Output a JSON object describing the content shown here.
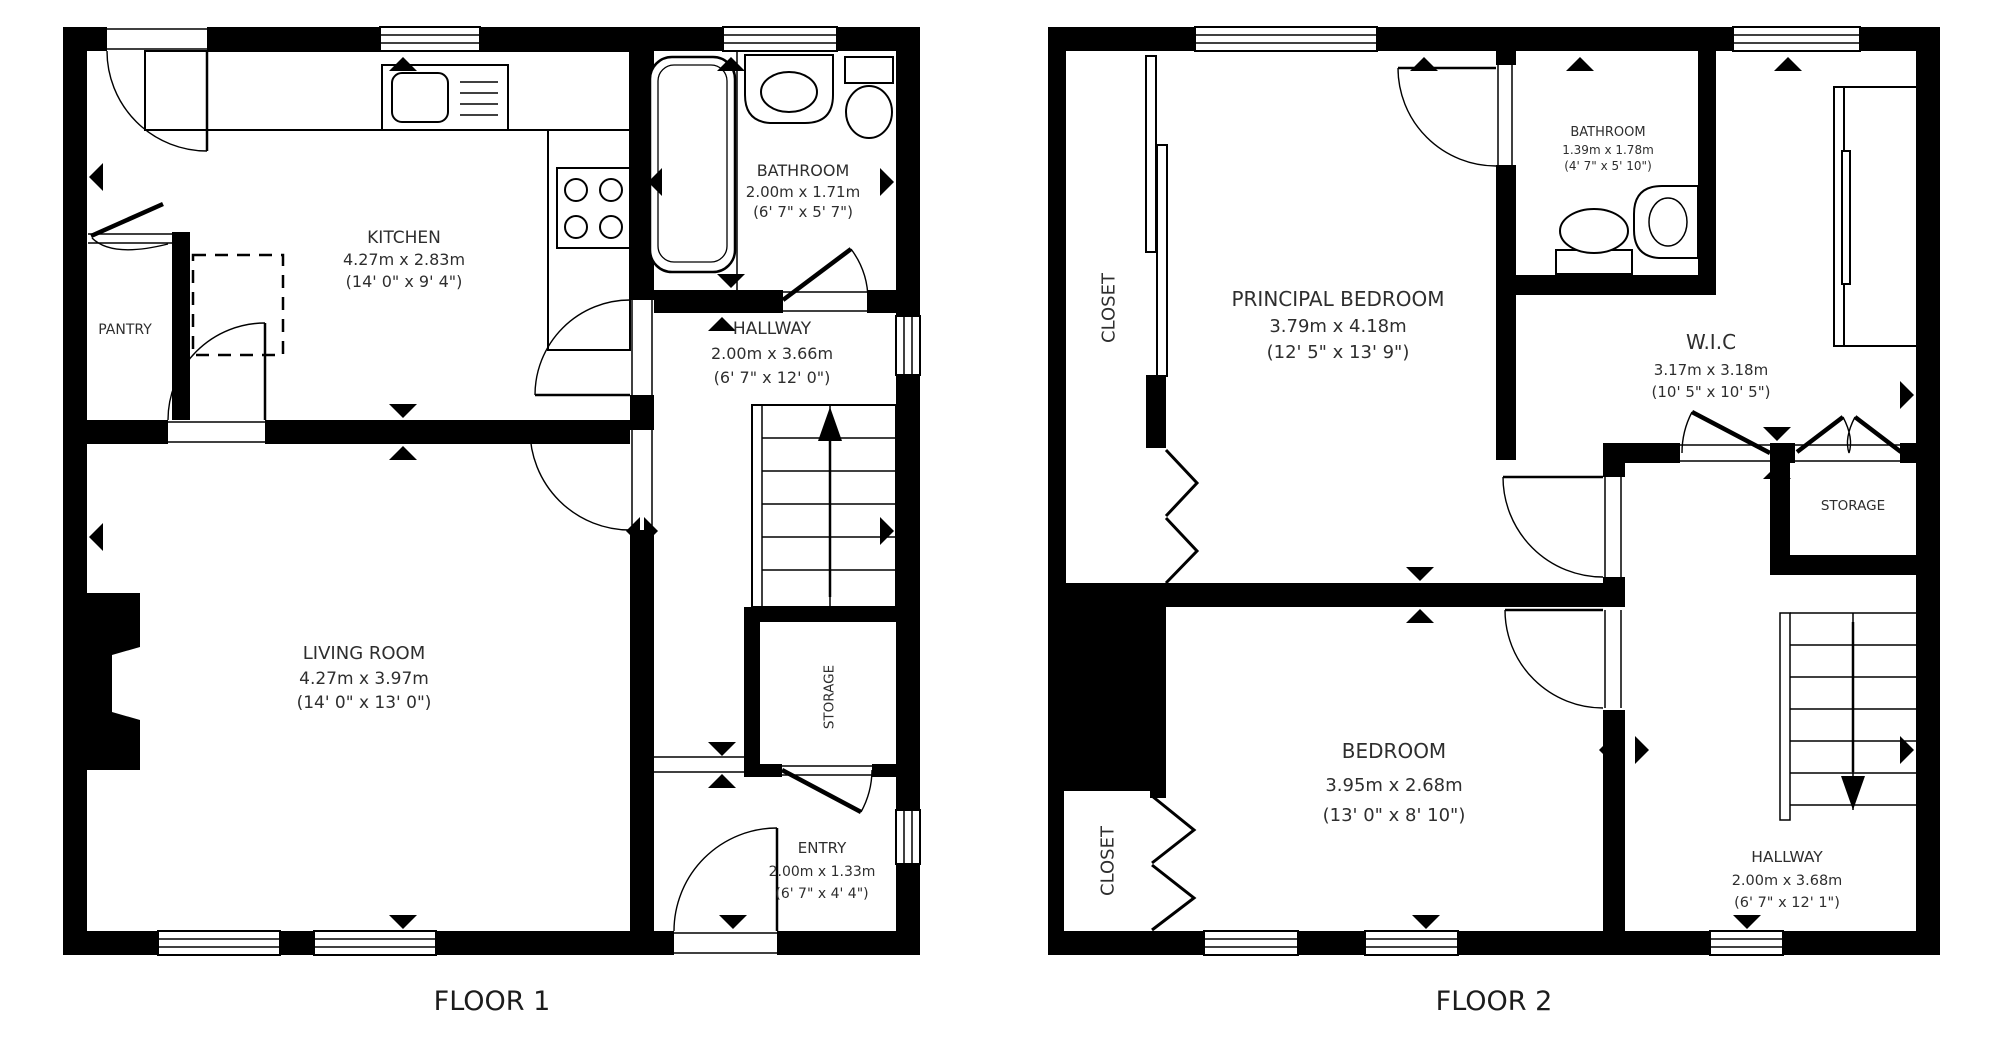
{
  "colors": {
    "walls": "#000000",
    "background": "#ffffff",
    "text": "#2e2e2e"
  },
  "floors": [
    {
      "label": "FLOOR 1",
      "rooms": [
        {
          "name": "KITCHEN",
          "dim_metric": "4.27m x 2.83m",
          "dim_imperial": "(14' 0\" x 9' 4\")"
        },
        {
          "name": "PANTRY"
        },
        {
          "name": "BATHROOM",
          "dim_metric": "2.00m x 1.71m",
          "dim_imperial": "(6' 7\" x 5' 7\")"
        },
        {
          "name": "HALLWAY",
          "dim_metric": "2.00m x 3.66m",
          "dim_imperial": "(6' 7\" x 12' 0\")"
        },
        {
          "name": "LIVING ROOM",
          "dim_metric": "4.27m x 3.97m",
          "dim_imperial": "(14' 0\" x 13' 0\")"
        },
        {
          "name": "STORAGE"
        },
        {
          "name": "ENTRY",
          "dim_metric": "2.00m x 1.33m",
          "dim_imperial": "(6' 7\" x 4' 4\")"
        }
      ]
    },
    {
      "label": "FLOOR 2",
      "rooms": [
        {
          "name": "CLOSET"
        },
        {
          "name": "PRINCIPAL BEDROOM",
          "dim_metric": "3.79m x 4.18m",
          "dim_imperial": "(12' 5\" x 13' 9\")"
        },
        {
          "name": "BATHROOM",
          "dim_metric": "1.39m x 1.78m",
          "dim_imperial": "(4' 7\" x 5' 10\")"
        },
        {
          "name": "W.I.C",
          "dim_metric": "3.17m x 3.18m",
          "dim_imperial": "(10' 5\" x 10' 5\")"
        },
        {
          "name": "STORAGE"
        },
        {
          "name": "BEDROOM",
          "dim_metric": "3.95m x 2.68m",
          "dim_imperial": "(13' 0\" x 8' 10\")"
        },
        {
          "name": "CLOSET"
        },
        {
          "name": "HALLWAY",
          "dim_metric": "2.00m x 3.68m",
          "dim_imperial": "(6' 7\" x 12' 1\")"
        }
      ]
    }
  ]
}
